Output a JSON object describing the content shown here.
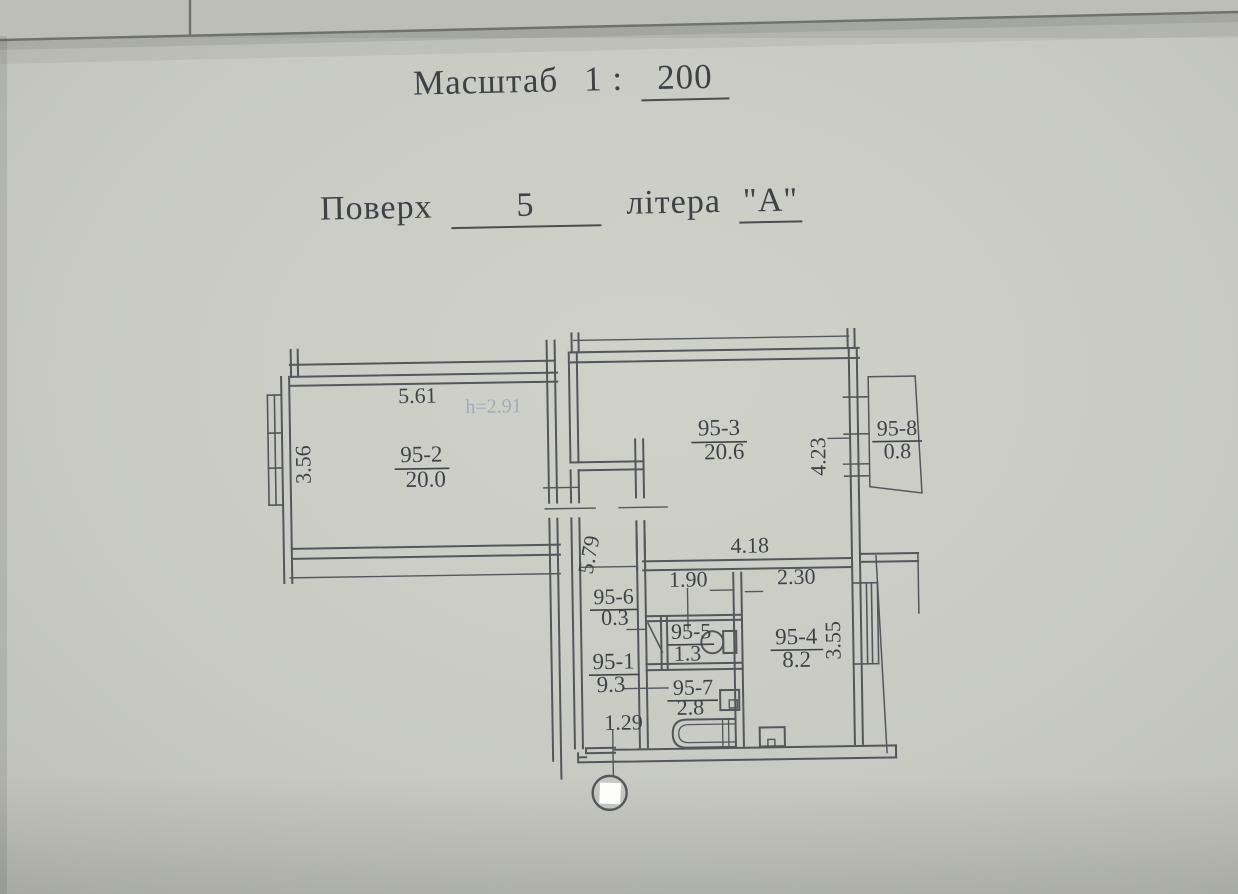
{
  "document": {
    "scale": {
      "label": "Масштаб",
      "ratio_prefix": "1 :",
      "value": "200"
    },
    "floor": {
      "label": "Поверх",
      "value": "5"
    },
    "letter": {
      "label": "літера",
      "value": "\"А\""
    }
  },
  "plan": {
    "ceiling_height_note": "h=2.91",
    "rooms": [
      {
        "number": "95-1",
        "area": "9.3"
      },
      {
        "number": "95-2",
        "area": "20.0"
      },
      {
        "number": "95-3",
        "area": "20.6"
      },
      {
        "number": "95-4",
        "area": "8.2"
      },
      {
        "number": "95-5",
        "area": "1.3"
      },
      {
        "number": "95-6",
        "area": "0.3"
      },
      {
        "number": "95-7",
        "area": "2.8"
      },
      {
        "number": "95-8",
        "area": "0.8"
      }
    ],
    "dimensions": {
      "room2_width": "5.61",
      "room2_depth": "3.56",
      "corridor_length": "5.79",
      "room3_bottom_width": "4.18",
      "room3_depth": "4.23",
      "wc_block_width": "1.90",
      "kitchen_width": "2.30",
      "kitchen_depth": "3.55",
      "entry_width": "1.29"
    },
    "icons": {
      "toilet": "toilet-icon",
      "bathtub": "bathtub-icon",
      "sink": "sink-icon",
      "stove": "stove-icon",
      "windows": "window-symbol",
      "entrance_mark": "entrance-stamp-circle"
    }
  }
}
